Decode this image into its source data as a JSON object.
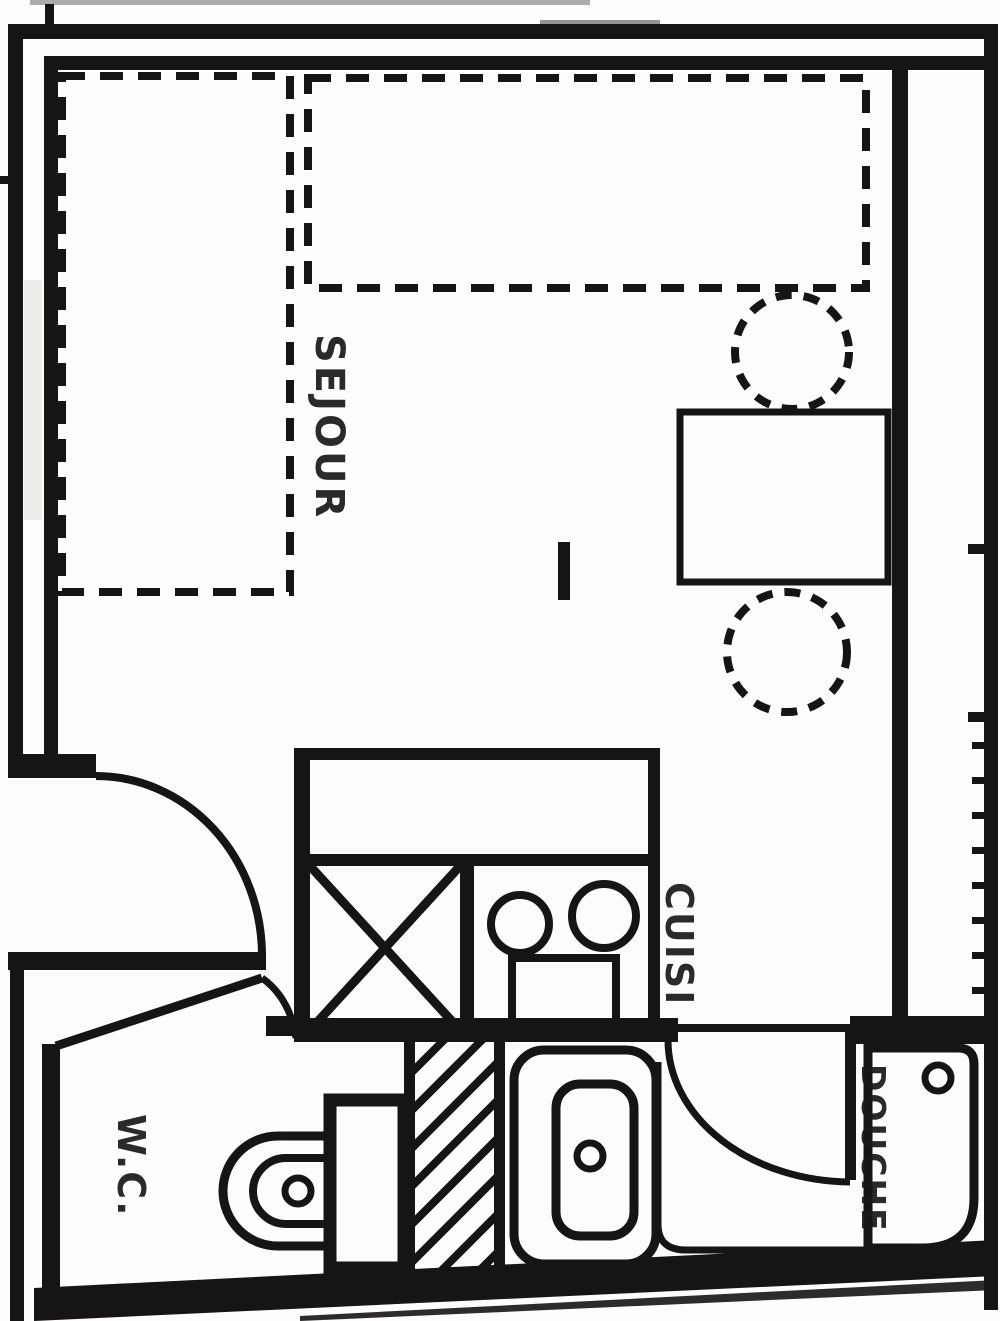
{
  "document": {
    "type": "scanned-floor-plan",
    "title": "Studio apartment floor plan"
  },
  "colors": {
    "ink": "#161514",
    "paper": "#fdfdfb"
  },
  "rooms": {
    "living": {
      "label": "SEJOUR"
    },
    "kitchen": {
      "label": "CUISI"
    },
    "wc": {
      "label": "W.C."
    },
    "shower": {
      "label": "DOUCHE"
    }
  }
}
